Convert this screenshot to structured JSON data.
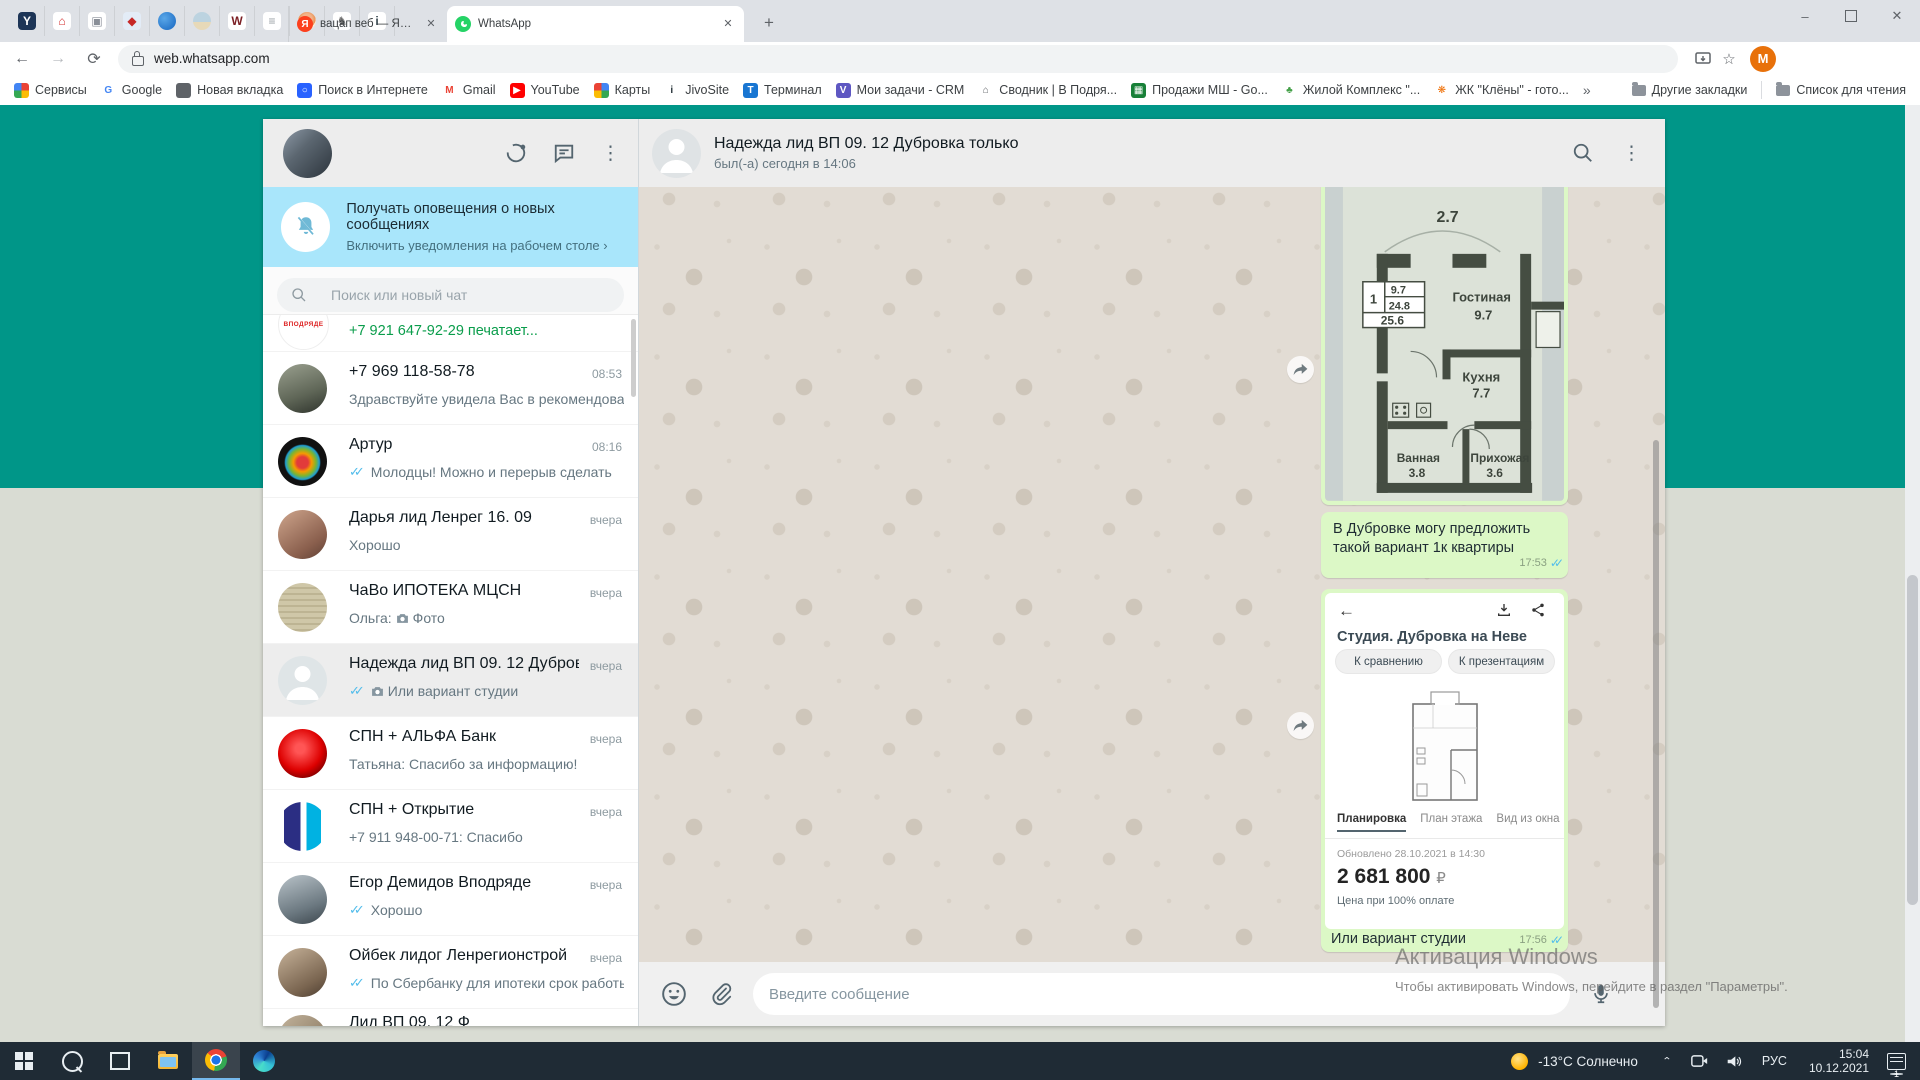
{
  "glyphs": {
    "ticks": "✓✓",
    "close": "✕",
    "plus": "+",
    "back": "←",
    "fwd": "→",
    "reload": "⟳",
    "overflow": "»",
    "min": "–",
    "kebab": "⋮",
    "chevron": "›",
    "star": "☆"
  },
  "browser": {
    "pinned_tabs": [
      {
        "name": "yandex-browser",
        "label": "Y",
        "fg": "#fff",
        "bg": "#1d3557"
      },
      {
        "name": "red-house",
        "label": "⌂",
        "fg": "#d32f2f",
        "bg": "#fff"
      },
      {
        "name": "frame-logo",
        "label": "▣",
        "fg": "#8a8f98",
        "bg": "#fff"
      },
      {
        "name": "emblem",
        "label": "◆",
        "fg": "#c62828",
        "bg": "#e3ecf7"
      },
      {
        "name": "blue-globe",
        "label": "",
        "fg": "#fff",
        "bg": "radial-gradient(circle at 35% 35%,#5aa7e8,#1565c0)",
        "circle": true
      },
      {
        "name": "landscape",
        "label": "",
        "fg": "#fff",
        "bg": "linear-gradient(180deg,#bcd3e0 55%,#e7d9b8 55%)",
        "circle": true
      },
      {
        "name": "maroon-w",
        "label": "W",
        "fg": "#7b1f24",
        "bg": "#fff"
      },
      {
        "name": "text-logo",
        "label": "≡",
        "fg": "#9aa0a6",
        "bg": "#fff"
      },
      {
        "name": "person-orange",
        "label": "",
        "fg": "#fff",
        "bg": "radial-gradient(circle at 50% 38%,#f2b38a 35%,#e98f4e 60%,#f8e9d9 61%)",
        "circle": true
      },
      {
        "name": "sketch-horse",
        "label": "♞",
        "fg": "#6d6d6d",
        "bg": "#fff"
      },
      {
        "name": "jivosite",
        "label": "i",
        "fg": "#37474f",
        "bg": "#fff"
      }
    ],
    "tab_inactive": {
      "title": "вацап веб — Яндекс: нашлось 6",
      "favicon": "Я",
      "favicon_bg": "#fc3f1d"
    },
    "tab_active": {
      "title": "WhatsApp",
      "favicon_bg": "#25d366"
    },
    "url": "web.whatsapp.com",
    "profile_initial": "M",
    "bookmarks": [
      {
        "label": "Сервисы",
        "glyph": "",
        "fg": "#fff",
        "bg": "conic-gradient(#ea4335 0 90deg,#fbbc05 0 180deg,#34a853 0 270deg,#4285f4 0 360deg)"
      },
      {
        "label": "Google",
        "glyph": "G",
        "fg": "#4285f4",
        "bg": "#fff"
      },
      {
        "label": "Новая вкладка",
        "glyph": "",
        "fg": "#fff",
        "bg": "#5f6368",
        "circle": true
      },
      {
        "label": "Поиск в Интернете",
        "glyph": "○",
        "fg": "#fff",
        "bg": "#2962ff"
      },
      {
        "label": "Gmail",
        "glyph": "M",
        "fg": "#ea4335",
        "bg": "#fff"
      },
      {
        "label": "YouTube",
        "glyph": "▶",
        "fg": "#fff",
        "bg": "#f00"
      },
      {
        "label": "Карты",
        "glyph": "",
        "fg": "#fff",
        "bg": "conic-gradient(#4285f4 0 90deg,#34a853 0 180deg,#fbbc04 0 270deg,#ea4335 0 360deg)",
        "circle": true
      },
      {
        "label": "JivoSite",
        "glyph": "i",
        "fg": "#263238",
        "bg": "#fff"
      },
      {
        "label": "Терминал",
        "glyph": "T",
        "fg": "#fff",
        "bg": "#1976d2"
      },
      {
        "label": "Мои задачи - CRM",
        "glyph": "V",
        "fg": "#fff",
        "bg": "#5e57c2"
      },
      {
        "label": "Сводник | В Подря...",
        "glyph": "⌂",
        "fg": "#5f6368",
        "bg": "#fff"
      },
      {
        "label": "Продажи МШ - Go...",
        "glyph": "▦",
        "fg": "#fff",
        "bg": "#188038"
      },
      {
        "label": "Жилой Комплекс \"...",
        "glyph": "♣",
        "fg": "#43a047",
        "bg": "#fff"
      },
      {
        "label": "ЖК \"Клёны\" - гото...",
        "glyph": "❋",
        "fg": "#ef6c00",
        "bg": "#fff"
      }
    ],
    "other_bookmarks": "Другие закладки",
    "reading_list": "Список для чтения"
  },
  "wa": {
    "sidebar": {
      "banner": {
        "title": "Получать оповещения о новых сообщениях",
        "subtitle": "Включить уведомления на рабочем столе ›"
      },
      "search_placeholder": "Поиск или новый чат",
      "typing": {
        "avatar_label": "ВПОДРЯДЕ",
        "text": "+7 921 647-92-29 печатает..."
      },
      "chats": [
        {
          "name": "+7 969 118-58-78",
          "time": "08:53",
          "text": "Здравствуйте увидела  Вас в рекомендованном ...",
          "avatar_bg": "linear-gradient(160deg,#9aa08f,#5f6657 60%,#2e332c)"
        },
        {
          "name": "Артур",
          "time": "08:16",
          "text": "Молодцы!  Можно и перерыв сделать",
          "ticks": true,
          "avatar_bg": "radial-gradient(circle at 50% 52%,#e23b3b 0 16%,#f59b00 26%,#7cb52f 38%,#1e9fd4 48%,#111 52%)"
        },
        {
          "name": "Дарья лид Ленрег 16. 09",
          "time": "вчера",
          "text": "Хорошо",
          "avatar_bg": "linear-gradient(145deg,#cfa68d,#8a5f4d 70%,#5e4034)"
        },
        {
          "name": "ЧаВо ИПОТЕКА МЦСН",
          "time": "вчера",
          "prefix": "Ольга:",
          "camera": true,
          "text": "Фото",
          "avatar_bg": "repeating-linear-gradient(180deg,#cfc7a8 0 4px,#bdb493 4px 6px)"
        },
        {
          "name": "Надежда лид ВП 09. 12 Дубровка...",
          "time": "вчера",
          "ticks": true,
          "camera": true,
          "text": "Или вариант студии",
          "selected": true,
          "default_avatar": true,
          "avatar_bg": "#dfe5e7"
        },
        {
          "name": "СПН + АЛЬФА Банк",
          "time": "вчера",
          "text": "Татьяна: Спасибо за информацию!",
          "avatar_bg": "radial-gradient(circle at 45% 40%,#f55 0 12%,#d00 55%,#8d0000 75%,#f3f3f3 76%)"
        },
        {
          "name": "СПН + Открытие",
          "time": "вчера",
          "text": "+7 911 948-00-71: Спасибо",
          "avatar_bg": "linear-gradient(90deg,#fff 0 12%,#2b2e83 12% 46%,#fff 46% 58%,#00b2e2 58% 88%,#fff 88%)"
        },
        {
          "name": "Егор Демидов Вподряде",
          "time": "вчера",
          "ticks": true,
          "text": "Хорошо",
          "avatar_bg": "linear-gradient(160deg,#b9c3c9,#6b7880 65%,#3c464d)"
        },
        {
          "name": "Ойбек лидог Ленрегионстрой",
          "time": "вчера",
          "ticks": true,
          "text": "По Сбербанку для ипотеки срок работы на ...",
          "avatar_bg": "linear-gradient(150deg,#c7b39a,#7a6550 70%,#4c3d30)"
        }
      ],
      "partial_name": "Лид ВП 09. 12 Ф"
    },
    "chat": {
      "header": {
        "title": "Надежда лид ВП 09. 12 Дубровка только",
        "subtitle": "был(-а) сегодня в 14:06"
      },
      "plan": {
        "dim": "2.7",
        "stamp": {
          "num": "1",
          "a": "9.7",
          "b": "24.8",
          "c": "25.6"
        },
        "rooms": [
          {
            "n": "Гостиная",
            "a": "9.7"
          },
          {
            "n": "Кухня",
            "a": "7.7"
          },
          {
            "n": "Ванная",
            "a": "3.8"
          },
          {
            "n": "Прихожая",
            "a": "3.6"
          }
        ]
      },
      "msg_text": {
        "text": "В Дубровке могу предложить такой вариант 1к квартиры",
        "time": "17:53"
      },
      "card": {
        "title": "Студия. Дубровка на Неве",
        "btn1": "К сравнению",
        "btn2": "К презентациям",
        "tabs": [
          "Планировка",
          "План этажа",
          "Вид из окна"
        ],
        "updated": "Обновлено 28.10.2021 в 14:30",
        "price": "2 681 800",
        "currency": "₽",
        "note": "Цена при 100% оплате",
        "caption": "Или вариант студии",
        "time": "17:56"
      },
      "input_placeholder": "Введите сообщение"
    }
  },
  "watermark": {
    "line1": "Активация Windows",
    "line2": "Чтобы активировать Windows, перейдите в раздел \"Параметры\"."
  },
  "taskbar": {
    "weather": "-13°C Солнечно",
    "lang": "РУС",
    "time": "15:04",
    "date": "10.12.2021",
    "badge": "1"
  }
}
